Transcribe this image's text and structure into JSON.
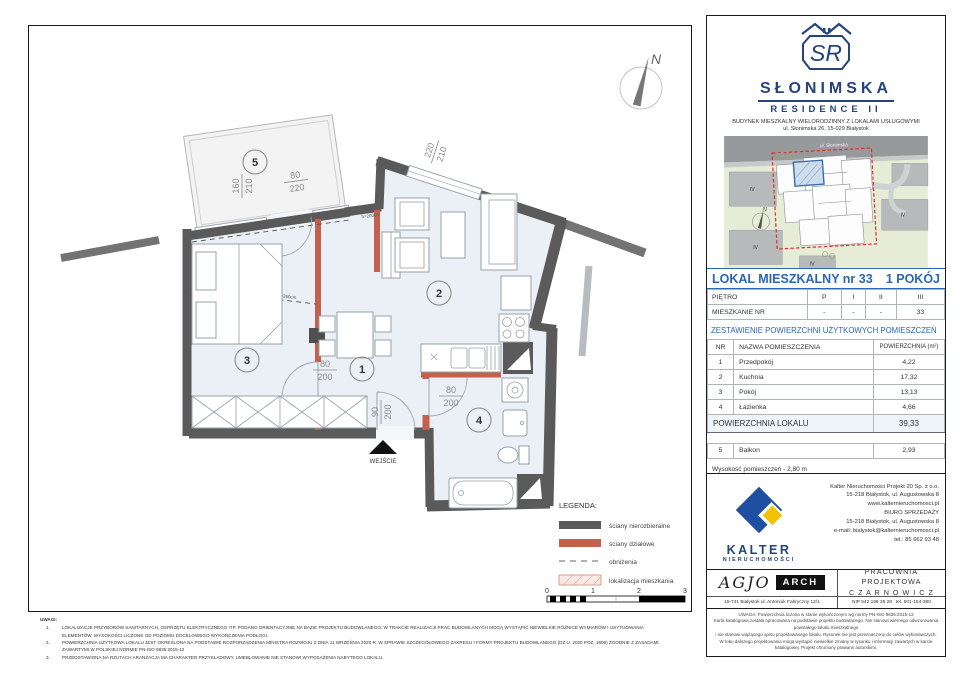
{
  "plan": {
    "rooms": {
      "r1": "1",
      "r2": "2",
      "r3": "3",
      "r4": "4",
      "r5": "5"
    },
    "dims": {
      "balcony_v_top": "160",
      "balcony_v_bot": "210",
      "balcony_door_top": "80",
      "balcony_door_bot": "220",
      "window_top": "220",
      "window_bot": "210",
      "door1_top": "80",
      "door1_bot": "200",
      "entry_top": "90",
      "entry_bot": "200",
      "bath_top": "80",
      "bath_bot": "200"
    },
    "entrance_label": "WEJŚCIE",
    "compass_n": "N",
    "lowered_note": "h=260cm",
    "legend": {
      "title": "LEGENDA:",
      "items": [
        {
          "label": "ściany nierozbieralne"
        },
        {
          "label": "ściany działowe"
        },
        {
          "label": "obniżenia"
        },
        {
          "label": "lokalizacja mieszkania"
        }
      ]
    },
    "scale": {
      "t0": "0",
      "t1": "1",
      "t2": "2",
      "t3": "3"
    }
  },
  "uwagi": {
    "title": "UWAGI:",
    "items": [
      {
        "n": "1.",
        "text": "LOKALIZACJE PRZYBORÓW SANITARNYCH, OSPRZĘTU ELEKTRYCZNEGO ITP. PODANO ORIENTACYJNIE NA BAZIE PROJEKTU BUDOWLANEGO. W TRAKCIE REALIZACJI PRAC BUDOWLANYCH MOGĄ WYSTĄPIĆ NIEWIELKIE RÓŻNICE WYMIARÓW I USYTUOWANIA ELEMENTÓW. WYSOKOŚCI LICZONE OD POZIOMU DOCELOWEGO WYKOŃCZENIA PODŁOGI."
      },
      {
        "n": "2.",
        "text": "POWIERZCHNIA UŻYTKOWA LOKALU JEST OKREŚLONA NA PODSTAWIE ROZPORZĄDZENIA MINISTRA ROZWOJU Z DNIA 11 WRZEŚNIA 2020 R. W SPRAWIE SZCZEGÓŁOWEGO ZAKRESU I FORMY PROJEKTU BUDOWLANEGO (DZ.U. 2020 POZ. 1609) ZGODNIE Z ZASADAMI ZAWARTYMI W POLSKIEJ NORMIE PN-ISO 9836:2015-12"
      },
      {
        "n": "3.",
        "text": "PRZEDSTAWIONA NA RZUTACH ARANŻACJA MA CHARAKTER PRZYKŁADOWY. UMEBLOWANIE NIE STANOWI WYPOSAŻENIA NABYTEGO LOKALU."
      }
    ]
  },
  "panel": {
    "brand": {
      "monogram": "SR",
      "name": "SŁONIMSKA",
      "sub": "RESIDENCE II",
      "desc1": "BUDYNEK MIESZKALNY WIELORODZINNY Z LOKALAMI USŁUGOWYMI",
      "desc2": "ul. Słonimska 26, 15-029 Białystok"
    },
    "map": {
      "street": "ul. Słonimska",
      "block_label": "IV",
      "compass_n": "N"
    },
    "title": {
      "left": "LOKAL MIESZKALNY  nr 33",
      "right": "1 POKÓJ"
    },
    "floor_table": {
      "rows": [
        [
          "PIĘTRO",
          "P",
          "I",
          "II",
          "III"
        ],
        [
          "MIESZKANIE NR",
          "-",
          "-",
          "-",
          "33"
        ]
      ]
    },
    "section_title": "ZESTAWIENIE POWIERZCHNI UŻYTKOWYCH POMIESZCZEŃ",
    "areas": {
      "headers": [
        "NR",
        "NAZWA POMIESZCZENIA",
        "POWIERZCHNIA (m²)"
      ],
      "rows": [
        [
          "1",
          "Przedpokój",
          "4,22"
        ],
        [
          "2",
          "Kuchnia",
          "17,32"
        ],
        [
          "3",
          "Pokój",
          "13,13"
        ],
        [
          "4",
          "Łazienka",
          "4,66"
        ]
      ],
      "total_label": "POWIERZCHNIA LOKALU",
      "total_value": "39,33",
      "extra": [
        "5",
        "Balkon",
        "2,93"
      ],
      "height_note": "Wysokość pomieszczeń - 2,80 m"
    },
    "kalter": {
      "name": "KALTER",
      "sub": "NIERUCHOMOŚCI",
      "lines": [
        "Kalter Nieruchomości Projekt 20  Sp. z o.o.",
        "15-218 Białystok, ul. Augustowska 8",
        "www.kalternieruchomosci.pl",
        "BIURO SPRZEDAŻY",
        "15-218 Białystok, ul. Augustowska 8",
        "e-mail: bialystok@kalternieruchomosci.pl",
        "tel.: 85 662 93 48"
      ]
    },
    "agjo": {
      "logo": "AGJO",
      "badge": "ARCH",
      "address": "15-741 Białystok   ul. Antoniuk Fabryczny  12/1",
      "prac1": "PRACOWNIA PROJEKTOWA",
      "prac2": "C Z A R N O W I C Z",
      "nip": "NIP  542 198 35 28",
      "tel": "tel. 501-154-380"
    },
    "fineprint": [
      "UWAGA:  Powierzchnia liczona w stanie wykończonym wg normy PN-ISO 9836:2015-12",
      "Karta katalogowa została opracowana na podstawie projektu budowlanego. Nie stanowi wiernego odwzorowania powstałego lokalu mieszkalnego",
      "i nie stanowi wiążącego opisu projektowanego lokalu. Rysunek nie jest przeznaczony do celów wykonawczych.",
      "W toku dalszego projektowania mogą wystąpić niewielkie zmiany w rysunku i informacji zawartych w karcie katalogowej. Projekt chroniony prawami autorskimi."
    ]
  }
}
